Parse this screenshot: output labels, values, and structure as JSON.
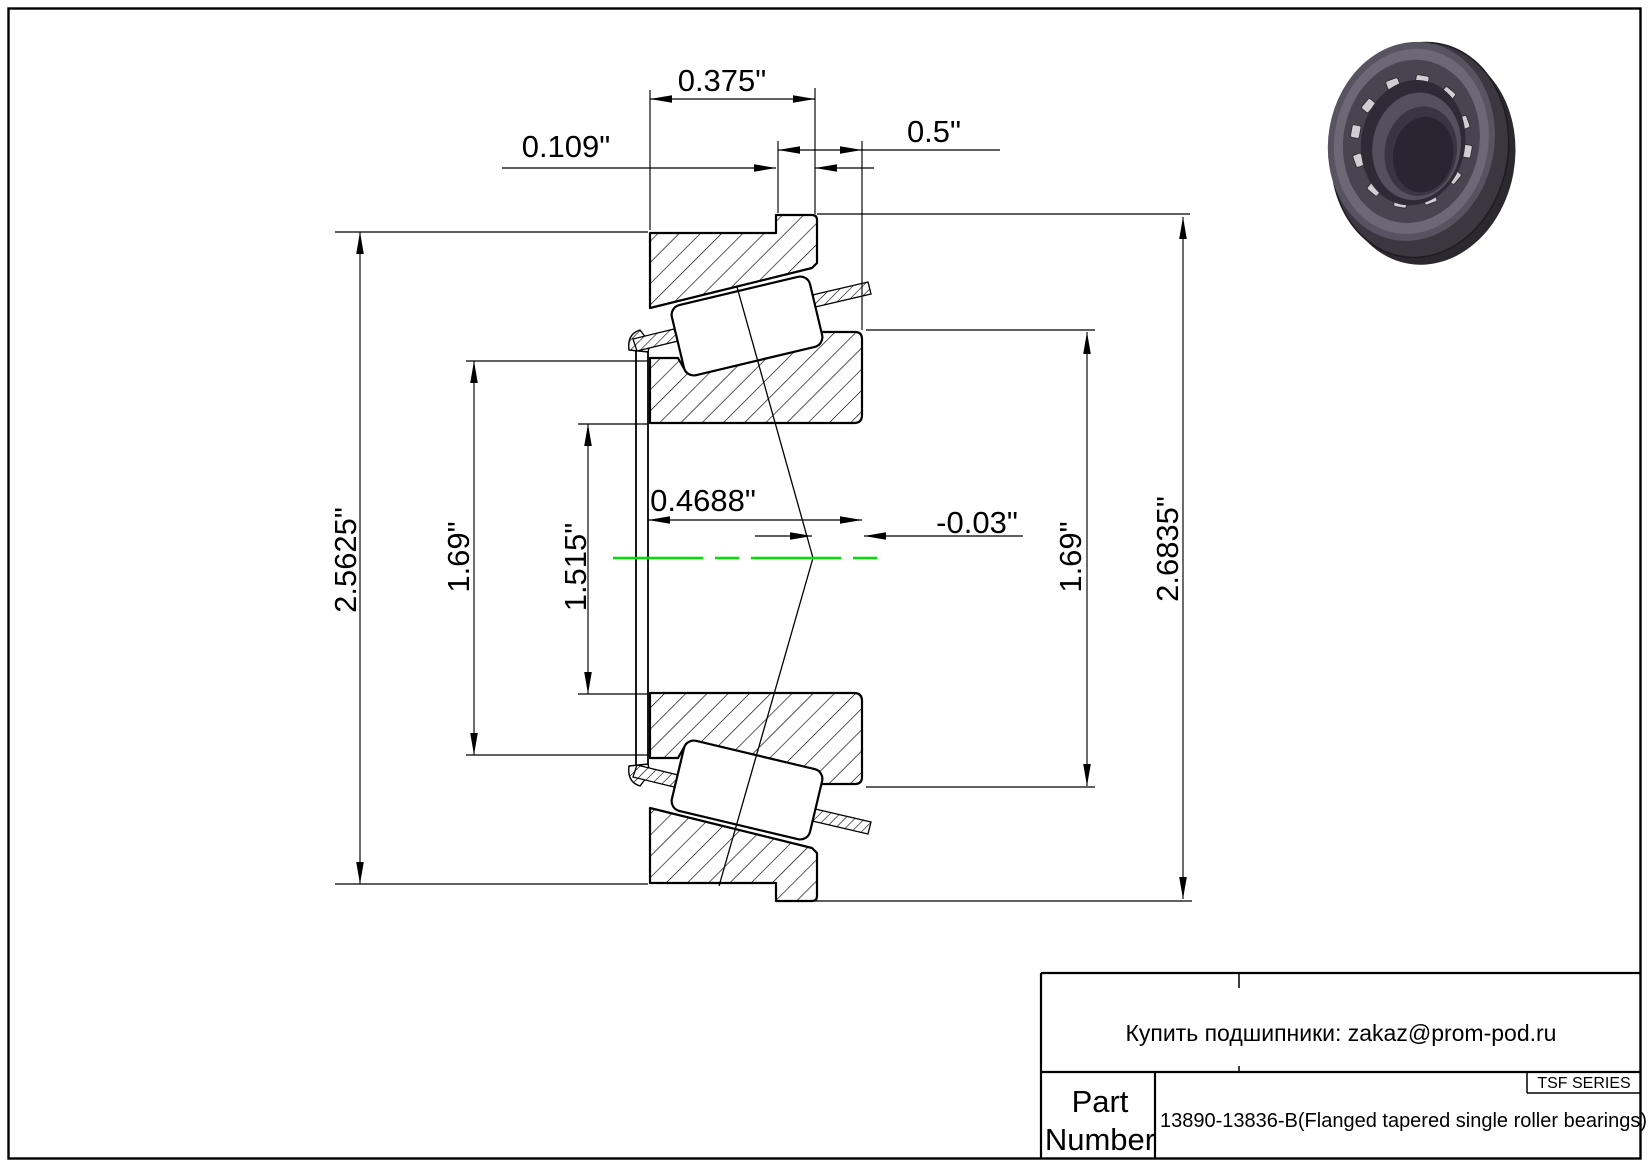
{
  "drawing": {
    "type": "flanged tapered single roller bearing cross-section",
    "dims": {
      "cup_width": "0.375\"",
      "flange_width": "0.109\"",
      "overall_width": "0.5\"",
      "cup_od": "2.5625\"",
      "cone_front_od": "1.69\"",
      "bore": "1.515\"",
      "cage_standout": "0.4688\"",
      "effective_center": "-0.03\"",
      "cone_back_od": "1.69\"",
      "flange_od": "2.6835\""
    },
    "centerline_color": "#00dd00",
    "line_color": "#000000"
  },
  "title_block": {
    "contact": "Купить подшипники: zakaz@prom-pod.ru",
    "part_label_line1": "Part",
    "part_label_line2": "Number",
    "series": "TSF SERIES",
    "part_number": "13890-13836-B(Flanged tapered single roller bearings)"
  },
  "preview": {
    "name": "bearing-3d-render"
  }
}
